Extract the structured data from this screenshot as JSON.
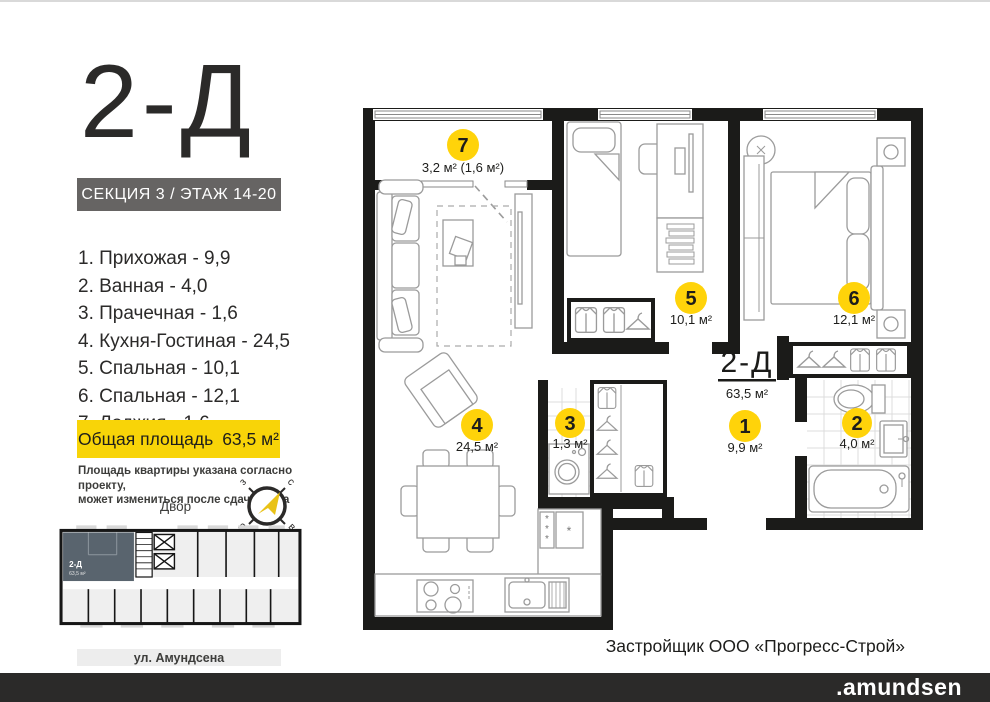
{
  "header": {
    "unit_code": "2-Д",
    "section_floor": "СЕКЦИЯ 3 / ЭТАЖ 14-20"
  },
  "room_list": [
    "1. Прихожая - 9,9",
    "2. Ванная - 4,0",
    "3. Прачечная - 1,6",
    "4. Кухня-Гостиная - 24,5",
    "5. Спальная - 10,1",
    "6. Спальная - 12,1",
    "7. Лоджия - 1,6"
  ],
  "total_area": {
    "label": "Общая площадь",
    "value": "63,5 м²"
  },
  "disclaimer_line1": "Площадь квартиры указана согласно проекту,",
  "disclaimer_line2": "может измениться  после сдачи дома",
  "yard_label": "Двор",
  "street_label": "ул. Амундсена",
  "compass": {
    "north": "с",
    "south": "ю",
    "west": "з",
    "east": "в"
  },
  "plan": {
    "unit_code": "2-Д",
    "unit_area": "63,5 м²",
    "rooms": [
      {
        "num": "1",
        "area": "9,9 м²"
      },
      {
        "num": "2",
        "area": "4,0 м²"
      },
      {
        "num": "3",
        "area": "1,3 м²"
      },
      {
        "num": "4",
        "area": "24,5 м²"
      },
      {
        "num": "5",
        "area": "10,1 м²"
      },
      {
        "num": "6",
        "area": "12,1 м²"
      },
      {
        "num": "7",
        "area": "3,2 м² (1,6 м²)"
      }
    ]
  },
  "mini_plan": {
    "unit_code": "2-Д",
    "unit_area": "63,5 м²"
  },
  "footer": {
    "developer": "Застройщик ООО «Прогресс-Строй»",
    "brand": ".amundsen"
  },
  "colors": {
    "accent_yellow": "#F8D408",
    "badge_yellow": "#FFD30A",
    "wall_black": "#1B1B19",
    "band_gray": "#666463",
    "highlight_slate": "#59646E",
    "footer_bar": "#2B2A29"
  }
}
